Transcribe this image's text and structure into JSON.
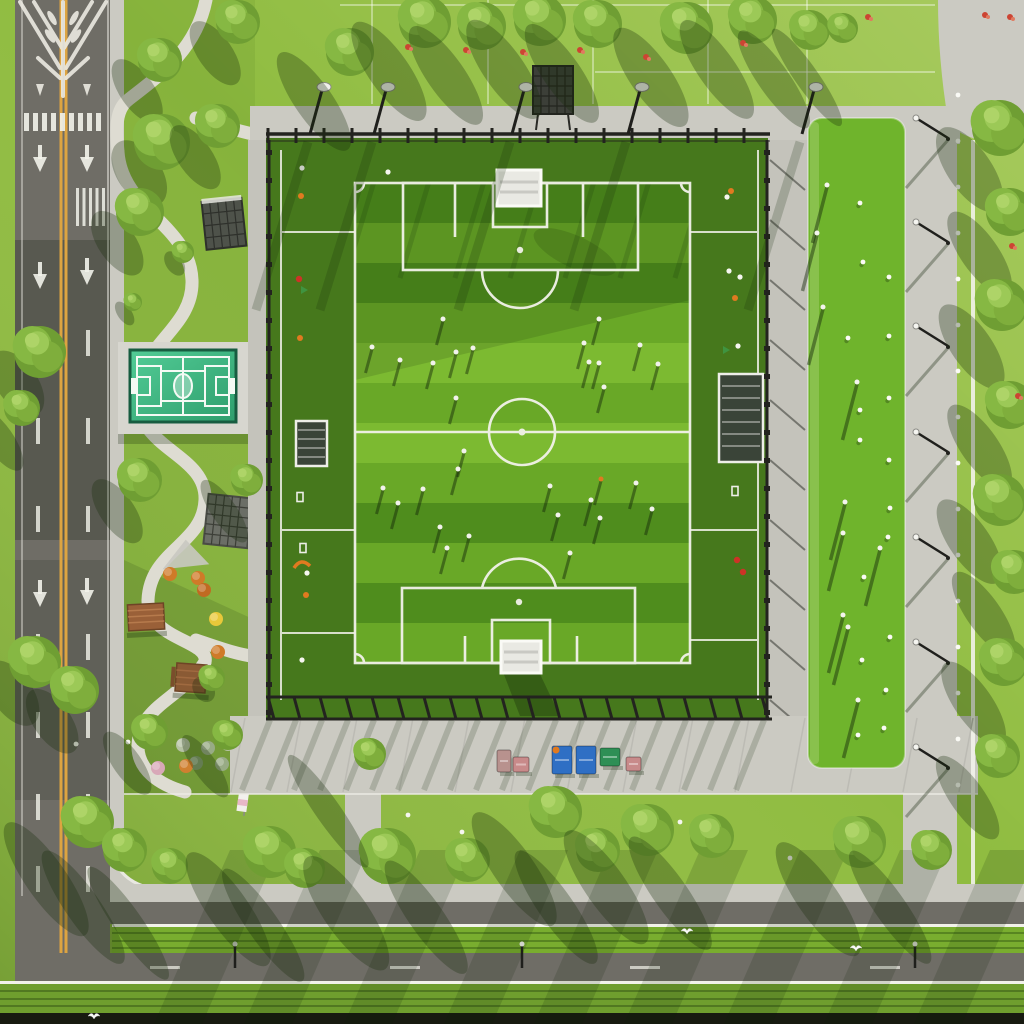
{
  "meta": {
    "description": "Aerial top-down view of a fenced soccer stadium field with players, a bright green practice field on the right, a small teal mini-court and landscaped park with winding paths on the left, a vertical road with yellow center line and white arrows on the far left, rows of trees casting long shadows, and a horizontal boulevard with hedge medians at the bottom."
  },
  "palette": {
    "grass": "#8fbc40",
    "grass_deep": "#6f9e2e",
    "asphalt": "#6f6d66",
    "asphalt_dark": "#56544c",
    "concrete": "#cbcac2",
    "concrete_bright": "#dbdad2",
    "line_white": "#f2f2ea",
    "road_yellow": "#dda441",
    "apron_green": "#46781c",
    "stripe_a": "#4f8d1d",
    "stripe_b": "#69a827",
    "stripe_light": "#7cba31",
    "practice_green": "#6fb42c",
    "court_teal": "#47c08b",
    "court_teal_dark": "#2f9e6d",
    "court_rim": "#175c40",
    "fence_dark": "#23231f",
    "hedge": "#79ad2f",
    "dark_band": "#171a10",
    "wood": "#9a6038",
    "cone_orange": "#e07a20",
    "cone_red": "#cc3326",
    "table_blue": "#2f6fc4",
    "table_green": "#2e8f55",
    "bench_pink": "#c88a8a",
    "shadow": "rgba(22,42,10,0.32)"
  },
  "scene": {
    "field": {
      "x": 355,
      "y": 183,
      "w": 335,
      "h": 480,
      "stripes": {
        "count": 12,
        "h": 40,
        "light_rows": [
          4,
          6
        ]
      },
      "center": {
        "cx": 522,
        "cy": 432,
        "r": 33
      },
      "penalty_spots": [
        [
          520,
          250
        ],
        [
          519,
          602
        ]
      ]
    },
    "field_players": [
      [
        443,
        319
      ],
      [
        599,
        319
      ],
      [
        372,
        347
      ],
      [
        400,
        360
      ],
      [
        433,
        363
      ],
      [
        456,
        352
      ],
      [
        473,
        348
      ],
      [
        584,
        343
      ],
      [
        589,
        362
      ],
      [
        599,
        363
      ],
      [
        640,
        345
      ],
      [
        658,
        364
      ],
      [
        604,
        387
      ],
      [
        456,
        398
      ],
      [
        464,
        451
      ],
      [
        458,
        469
      ],
      [
        383,
        488
      ],
      [
        423,
        489
      ],
      [
        398,
        503
      ],
      [
        550,
        486
      ],
      [
        591,
        500
      ],
      [
        636,
        483
      ],
      [
        558,
        515
      ],
      [
        600,
        518
      ],
      [
        652,
        509
      ],
      [
        440,
        527
      ],
      [
        469,
        536
      ],
      [
        447,
        548
      ],
      [
        570,
        553
      ]
    ],
    "field_players_orange": [
      [
        601,
        479
      ]
    ],
    "practice_players": [
      [
        827,
        185
      ],
      [
        817,
        233
      ],
      [
        823,
        307
      ],
      [
        857,
        382
      ],
      [
        845,
        502
      ],
      [
        843,
        533
      ],
      [
        880,
        548
      ],
      [
        843,
        615
      ],
      [
        848,
        627
      ],
      [
        858,
        700
      ]
    ],
    "practice_balls": [
      [
        860,
        203
      ],
      [
        863,
        262
      ],
      [
        889,
        277
      ],
      [
        848,
        338
      ],
      [
        889,
        336
      ],
      [
        860,
        410
      ],
      [
        889,
        398
      ],
      [
        860,
        440
      ],
      [
        889,
        460
      ],
      [
        890,
        508
      ],
      [
        888,
        537
      ],
      [
        864,
        577
      ],
      [
        890,
        637
      ],
      [
        862,
        660
      ],
      [
        886,
        690
      ],
      [
        858,
        735
      ],
      [
        884,
        728
      ]
    ],
    "trees_top": [
      [
        350,
        52,
        24
      ],
      [
        425,
        22,
        26
      ],
      [
        482,
        26,
        24
      ],
      [
        540,
        20,
        26
      ],
      [
        598,
        24,
        24
      ],
      [
        687,
        28,
        26
      ],
      [
        753,
        20,
        24
      ],
      [
        810,
        30,
        20
      ],
      [
        843,
        28,
        15
      ]
    ],
    "trees_right": [
      [
        1000,
        128,
        28
      ],
      [
        1010,
        212,
        24
      ],
      [
        1002,
        305,
        26
      ],
      [
        1010,
        405,
        24
      ],
      [
        1000,
        500,
        26
      ],
      [
        1014,
        572,
        22
      ],
      [
        1004,
        662,
        24
      ],
      [
        998,
        756,
        22
      ]
    ],
    "trees_park": [
      [
        238,
        22,
        22
      ],
      [
        160,
        60,
        22
      ],
      [
        162,
        142,
        28
      ],
      [
        218,
        126,
        22
      ],
      [
        140,
        212,
        24
      ],
      [
        183,
        252,
        11
      ],
      [
        40,
        352,
        26
      ],
      [
        22,
        408,
        18
      ],
      [
        140,
        480,
        22
      ],
      [
        247,
        480,
        16
      ],
      [
        133,
        302,
        9
      ],
      [
        35,
        662,
        26
      ],
      [
        75,
        690,
        24
      ],
      [
        150,
        732,
        18
      ],
      [
        228,
        735,
        15
      ],
      [
        212,
        678,
        13
      ]
    ],
    "trees_strip": [
      [
        88,
        822,
        26
      ],
      [
        125,
        850,
        22
      ],
      [
        170,
        866,
        18
      ],
      [
        270,
        852,
        26
      ],
      [
        305,
        868,
        20
      ],
      [
        388,
        856,
        28
      ],
      [
        468,
        860,
        22
      ],
      [
        556,
        812,
        26
      ],
      [
        598,
        850,
        22
      ],
      [
        648,
        830,
        26
      ],
      [
        712,
        836,
        22
      ],
      [
        860,
        842,
        26
      ],
      [
        932,
        850,
        20
      ],
      [
        370,
        754,
        16
      ]
    ],
    "flowers_red": [
      [
        408,
        47
      ],
      [
        466,
        50
      ],
      [
        523,
        52
      ],
      [
        580,
        50
      ],
      [
        646,
        57
      ],
      [
        743,
        43
      ],
      [
        868,
        17
      ],
      [
        985,
        15
      ],
      [
        1010,
        17
      ],
      [
        1012,
        246
      ],
      [
        1018,
        396
      ]
    ],
    "park_shrubs": [
      [
        183,
        745,
        "#b6c2a4"
      ],
      [
        208,
        748,
        "#98ab85"
      ],
      [
        228,
        744,
        "#b6c2a4"
      ],
      [
        196,
        763,
        "#86a072"
      ],
      [
        222,
        764,
        "#98ab85"
      ],
      [
        186,
        766,
        "#d08030"
      ],
      [
        158,
        768,
        "#d8a8b8"
      ],
      [
        170,
        574,
        "#cf7a28"
      ],
      [
        198,
        578,
        "#cf7a28"
      ],
      [
        204,
        590,
        "#c06a22"
      ],
      [
        218,
        652,
        "#cf7a28"
      ],
      [
        216,
        619,
        "#e8c83a"
      ]
    ],
    "misc_white_dots": [
      [
        76,
        744
      ],
      [
        128,
        742
      ],
      [
        408,
        815
      ],
      [
        462,
        832
      ],
      [
        680,
        822
      ],
      [
        790,
        858
      ],
      [
        548,
        800
      ]
    ],
    "left_strip_items": [
      [
        302,
        168,
        "w"
      ],
      [
        301,
        196,
        "o"
      ],
      [
        299,
        279,
        "r"
      ],
      [
        304,
        290,
        "g"
      ],
      [
        300,
        338,
        "o"
      ],
      [
        300,
        497,
        "m"
      ],
      [
        303,
        548,
        "m"
      ],
      [
        307,
        573,
        "w"
      ],
      [
        306,
        595,
        "o"
      ],
      [
        302,
        660,
        "w"
      ],
      [
        388,
        172,
        "w"
      ]
    ],
    "right_strip_items": [
      [
        731,
        191,
        "o"
      ],
      [
        727,
        197,
        "w"
      ],
      [
        729,
        271,
        "w"
      ],
      [
        740,
        277,
        "w"
      ],
      [
        735,
        298,
        "o"
      ],
      [
        738,
        346,
        "w"
      ],
      [
        726,
        350,
        "g"
      ],
      [
        735,
        491,
        "m"
      ],
      [
        737,
        560,
        "r"
      ],
      [
        743,
        572,
        "r"
      ]
    ],
    "plaza_tables": [
      {
        "x": 497,
        "y": 750,
        "w": 14,
        "h": 22,
        "c": "#b8928e"
      },
      {
        "x": 513,
        "y": 757,
        "w": 16,
        "h": 15,
        "c": "#c88a8a"
      },
      {
        "x": 552,
        "y": 746,
        "w": 20,
        "h": 28,
        "c": "#2f6fc4"
      },
      {
        "x": 576,
        "y": 746,
        "w": 20,
        "h": 28,
        "c": "#2f6fc4"
      },
      {
        "x": 600,
        "y": 748,
        "w": 20,
        "h": 18,
        "c": "#2e8f55"
      },
      {
        "x": 626,
        "y": 757,
        "w": 15,
        "h": 14,
        "c": "#c88a8a"
      }
    ],
    "plaza_orange_figure": [
      556,
      750
    ],
    "crosswalk": {
      "x0": 24,
      "x1": 104,
      "y": 113,
      "h": 18,
      "step": 9,
      "bar_w": 5
    },
    "stripe_group": {
      "x0": 76,
      "x1": 104,
      "y": 188,
      "h": 38,
      "step": 6.5,
      "bar_w": 3
    },
    "road_arrows_down": [
      [
        40,
        145
      ],
      [
        87,
        145
      ],
      [
        87,
        258
      ],
      [
        40,
        262
      ],
      [
        87,
        578
      ],
      [
        40,
        580
      ]
    ],
    "lane_dashes": {
      "xs": [
        38,
        88
      ],
      "ys": [
        330,
        418,
        506,
        634,
        712,
        794,
        866
      ],
      "len": 26
    },
    "fence": {
      "top": {
        "x0": 268,
        "x1": 770,
        "y": 134,
        "step": 28
      },
      "left": {
        "x": 269,
        "y0": 150,
        "y1": 712,
        "step": 28
      },
      "right": {
        "x": 767,
        "y0": 150,
        "y1": 712,
        "step": 28
      },
      "bottom": {
        "x0": 268,
        "x1": 772,
        "y": 697,
        "step": 26
      }
    },
    "floodlights_top_x": [
      308,
      372,
      510,
      626,
      800
    ],
    "right_lamp_ys": [
      118,
      222,
      326,
      432,
      537,
      642,
      747
    ],
    "right_strip_balls": {
      "x": 958,
      "y0": 95,
      "y1": 795,
      "step": 46
    },
    "plaza_joints": {
      "x0": 245,
      "x1": 975,
      "step": 56,
      "y0": 718,
      "y1": 792
    },
    "plaza_streaks": {
      "x0": 280,
      "x1": 770,
      "step": 52
    },
    "field_post_streaks": {
      "x0": 385,
      "x1": 716,
      "step": 55
    },
    "bottom_streak_xs": [
      230,
      320,
      420,
      520,
      610,
      700,
      800,
      900,
      990
    ],
    "hedge_lamps": [
      [
        235,
        944
      ],
      [
        522,
        944
      ],
      [
        915,
        944
      ]
    ],
    "road2_dashes": [
      [
        150,
        966
      ],
      [
        390,
        966
      ],
      [
        630,
        966
      ],
      [
        870,
        966
      ]
    ],
    "birds": [
      [
        687,
        931
      ],
      [
        856,
        948
      ],
      [
        94,
        1016
      ]
    ],
    "top_grid": {
      "v_xs": [
        372,
        488,
        593,
        708,
        807
      ],
      "v_y0": 0,
      "v_y1": 104,
      "h_lines": [
        [
          340,
          935,
          5
        ],
        [
          595,
          935,
          72
        ]
      ]
    }
  }
}
